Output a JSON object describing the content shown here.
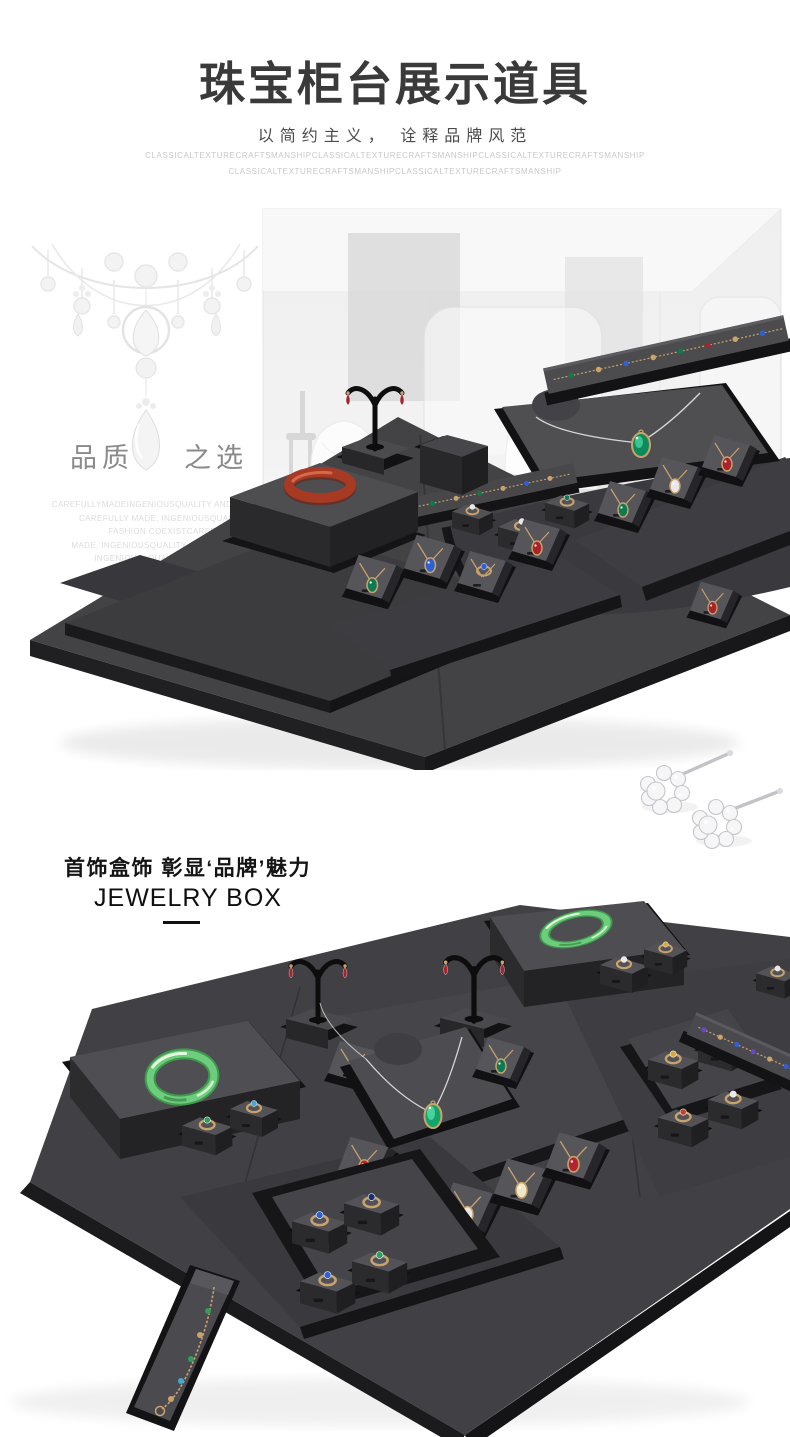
{
  "header": {
    "title": "珠宝柜台展示道具",
    "subtitle": "以简约主义， 诠释品牌风范",
    "watermark_line1": "CLASSICALTEXTURECRAFTSMANSHIPCLASSICALTEXTURECRAFTSMANSHIPCLASSICALTEXTURECRAFTSMANSHIP",
    "watermark_line2": "CLASSICALTEXTURECRAFTSMANSHIPCLASSICALTEXTURECRAFTSMANSHIP"
  },
  "showcase": {
    "tagline_left": "品质",
    "tagline_right": "之选",
    "fine_print": [
      "CAREFULLYMADEINGENIOUSQUALITY AND FASHION CO",
      "CAREFULLY MADE, INGENIOUSQUALITY AN",
      "FASHION COEXISTCAREFULL",
      "MADE, INGENIOUSQUALITY AND FASHION COE",
      "INGENIOUS, QUALITY AND FASHION"
    ]
  },
  "jewelry_box": {
    "heading": "首饰盒饰  彰显‘品牌’魅力",
    "subheading": "JEWELRY BOX"
  },
  "colors": {
    "title_text": "#3a3a3a",
    "subtitle_text": "#4a4a4a",
    "watermark_text": "#c8c8c8",
    "tagline_text": "#8a8a8a",
    "fine_print_text": "#dcdcdc",
    "heading_text": "#141414",
    "platform_top": "#4a4a4d",
    "platform_side": "#232326",
    "platform_tray": "#121214",
    "red_bangle": "#a83a24",
    "jade_bangle": "#6ecd7d",
    "gem_green": "#0e7a52",
    "gem_blue": "#2f5fd0",
    "gem_red": "#b3242e",
    "gold": "#c9a36b",
    "silver_chain": "#d6d6d6"
  }
}
